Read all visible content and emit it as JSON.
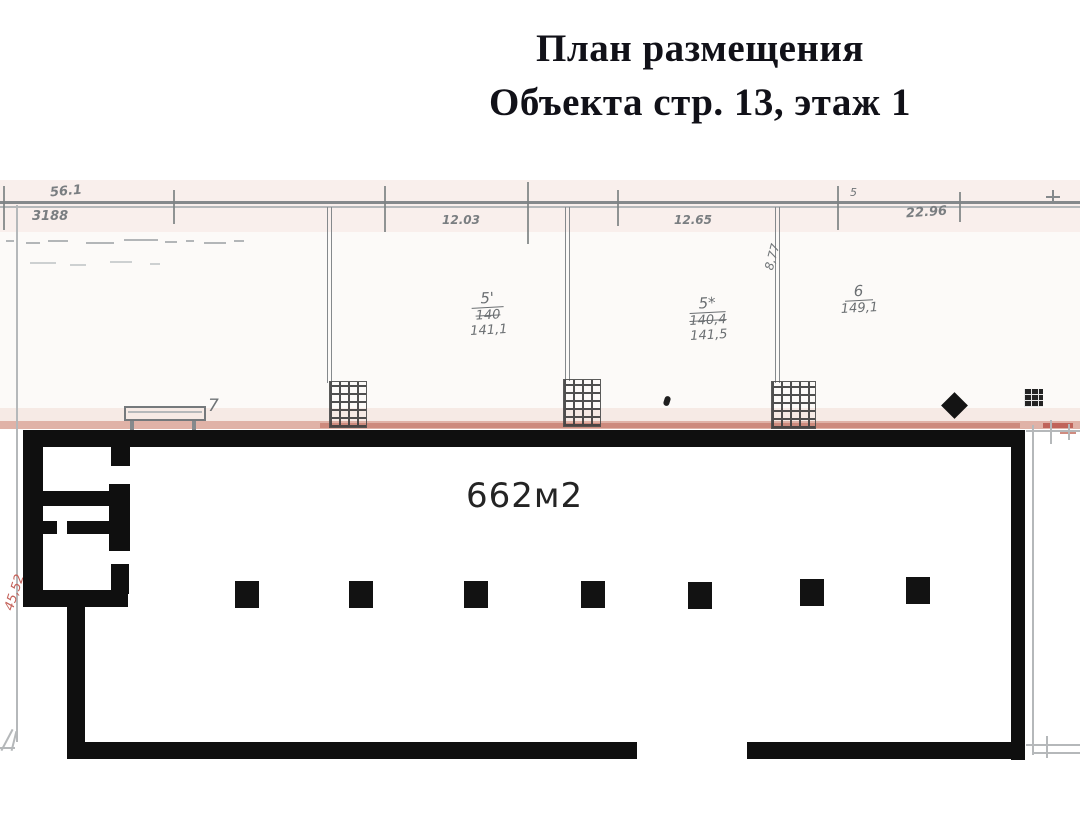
{
  "title": {
    "line1": "План размещения",
    "line2": "Объекта стр. 13, этаж 1"
  },
  "hall": {
    "area_label": "662м2",
    "column_count": 7
  },
  "upper_rooms": [
    {
      "number": "5'",
      "area_old": "140",
      "area_new": "141,1"
    },
    {
      "number": "5*",
      "area_old": "140,4",
      "area_new": "141,5"
    },
    {
      "number": "6",
      "area_old": "",
      "area_new": "149,1"
    }
  ],
  "dimensions": {
    "top_left_small": "56.1",
    "top_left_bold": "3188",
    "room1_width": "12.03",
    "room2_width": "12.65",
    "right_width": "22.96",
    "rooms_depth": "8,77",
    "left_height": "45,52",
    "bench_mark": "7",
    "small_mark": "5"
  },
  "colors": {
    "wall": "#0f0f0f",
    "pencil_gray": "#85898c",
    "handwriting_gray": "#6f7477",
    "pencil_red": "#c98275",
    "title_text": "#111118"
  }
}
